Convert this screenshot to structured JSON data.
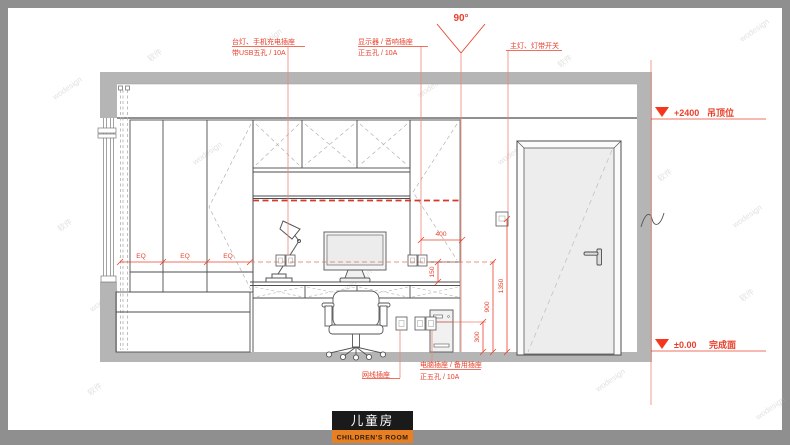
{
  "title_block": {
    "cn": "儿童房",
    "en": "CHILDREN'S ROOM"
  },
  "callouts": {
    "lamp_socket": {
      "line1": "台灯、手机充电插座",
      "line2": "带USB五孔 / 10A"
    },
    "monitor_socket": {
      "line1": "显示器 / 音响插座",
      "line2": "正五孔 / 10A"
    },
    "light_switch": {
      "line1": "主灯、灯带开关"
    },
    "network_socket": {
      "line1": "网线插座"
    },
    "computer_socket": {
      "line1": "电脑插座 / 备用插座",
      "line2": "正五孔 / 10A"
    }
  },
  "levels": {
    "ceiling": {
      "value": "+2400",
      "label": "吊顶位"
    },
    "floor": {
      "value": "±0.00",
      "label": "完成面"
    }
  },
  "dimensions": {
    "angle": "90°",
    "eq": "EQ",
    "socket_offset": "400",
    "line_to_desk": "150",
    "low_socket_height": "300",
    "socket_line_height": "900",
    "switch_height": "1350"
  },
  "colors": {
    "annotation_red": "#e8402c",
    "marker_red": "#f4371c",
    "title_orange": "#e87f22",
    "title_black": "#1a1a1a",
    "wall_gray": "#b5b5b5",
    "frame_gray": "#8f8f8f",
    "line_dark": "#4d4d4d"
  },
  "watermarks": {
    "latin": "wodesign",
    "cjk": "软件"
  }
}
